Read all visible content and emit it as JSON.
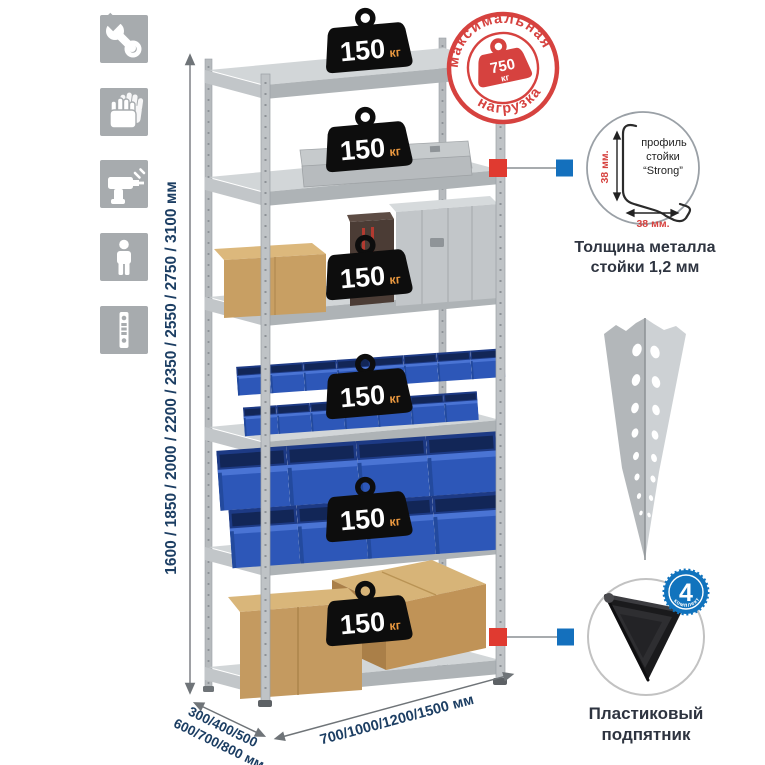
{
  "colors": {
    "accent_red": "#d6423f",
    "connector_red": "#e03a30",
    "connector_blue": "#1470bd",
    "bin_blue": "#2d57b8",
    "dim_text_navy": "#1c3e63",
    "caption_dark": "#2e3440",
    "icon_square_gray": "#a7abae",
    "metal_gray": "#c6cacd",
    "badge_black": "#0d0d0d",
    "badge_unit_orange": "#e8973f"
  },
  "icons": [
    {
      "name": "wrench"
    },
    {
      "name": "work-gloves"
    },
    {
      "name": "drill"
    },
    {
      "name": "person"
    },
    {
      "name": "perforated-profile"
    }
  ],
  "dimensions": {
    "height": "1600 / 1850 / 2000 / 2200 / 2350 / 2550 / 2750 / 3100 мм",
    "depth_line1": "300/400/500",
    "depth_line2": "600/700/800 мм",
    "width": "700/1000/1200/1500 мм"
  },
  "max_load_stamp": {
    "arc_top": "максимальная",
    "arc_bottom": "нагрузка",
    "value": "750",
    "unit": "кг"
  },
  "shelf_badges": [
    {
      "value": "150",
      "unit": "кг"
    },
    {
      "value": "150",
      "unit": "кг"
    },
    {
      "value": "150",
      "unit": "кг"
    },
    {
      "value": "150",
      "unit": "кг"
    },
    {
      "value": "150",
      "unit": "кг"
    },
    {
      "value": "150",
      "unit": "кг"
    }
  ],
  "profile_detail": {
    "label_line1": "профиль",
    "label_line2": "стойки",
    "label_line3": "“Strong”",
    "dim_vertical": "38 мм.",
    "dim_horizontal": "38 мм.",
    "caption_line1": "Толщина металла",
    "caption_line2": "стойки 1,2 мм"
  },
  "foot_detail": {
    "badge_value": "4",
    "badge_arc": "в комплекте",
    "caption_line1": "Пластиковый",
    "caption_line2": "подпятник"
  }
}
